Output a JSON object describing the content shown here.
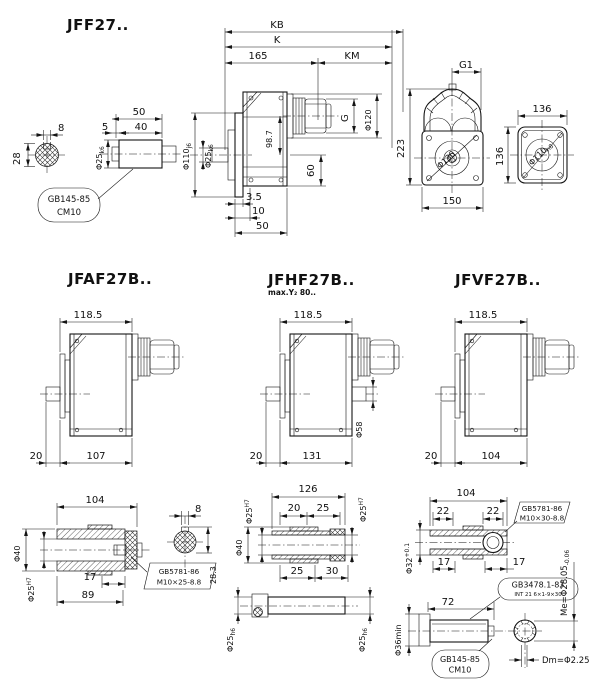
{
  "titles": {
    "jff27": "JFF27..",
    "jfaf27": "JFAF27B..",
    "jfhf27": "JFHF27B..",
    "jfhf27_sub": "max.Y₂ 80..",
    "jfvf27": "JFVF27B.."
  },
  "jff": {
    "key_w": "8",
    "key_h": "28",
    "n50": "50",
    "n5": "5",
    "n40": "40",
    "dia25_b": "Φ25",
    "dia25_s": "k6",
    "co1": "GB145-85",
    "co2": "CM10",
    "kb": "KB",
    "k": "K",
    "n165": "165",
    "km": "KM",
    "g": "G",
    "dia120": "Φ120",
    "n987": "98.7",
    "n60": "60",
    "dia110_b": "Φ110",
    "dia110_s": "j6",
    "dia25b_b": "Φ25",
    "dia25b_s": "k6",
    "n35": "3.5",
    "n10": "10",
    "n50b": "50",
    "g1": "G1",
    "n223": "223",
    "n150": "150",
    "dia130": "Φ130",
    "n136t": "136",
    "n136l": "136",
    "dia110f_b": "Φ110",
    "dia110f_s": "h8"
  },
  "mid": {
    "n1185": "118.5",
    "l20": "20",
    "l107": "107",
    "m20": "20",
    "m131": "131",
    "dia58": "Φ58",
    "r20": "20",
    "r104": "104"
  },
  "ha": {
    "n104": "104",
    "dia40": "Φ40",
    "dia25_b": "Φ25",
    "dia25_s": "H7",
    "n17": "17",
    "n89": "89",
    "c1": "GB5781-86",
    "c2": "M10×25-8.8",
    "key_w": "8",
    "key_h": "28.3"
  },
  "bu": {
    "n126": "126",
    "diaL_b": "Φ25",
    "diaL_s": "H7",
    "diaR_b": "Φ25",
    "diaR_s": "H7",
    "n20": "20",
    "n25a": "25",
    "dia40": "Φ40",
    "n25b": "25",
    "n30": "30",
    "sdL_b": "Φ25",
    "sdL_s": "h6",
    "sdR_b": "Φ25",
    "sdR_s": "h6"
  },
  "hb": {
    "n104": "104",
    "n22a": "22",
    "n22b": "22",
    "dia32_b": "Φ32",
    "dia32_s": "+0.1",
    "n17a": "17",
    "n17b": "17",
    "n72": "72",
    "c1": "GB5781-86",
    "c2": "M10×30-8.8",
    "s1": "GB3478.1-83",
    "s2": "INT 21 6×1-9×30",
    "me": "Me=Φ28.05",
    "me_s": "-0.06",
    "dia36": "Φ36min",
    "cm1": "GB145-85",
    "cm2": "CM10",
    "dm": "Dm=Φ2.25"
  }
}
